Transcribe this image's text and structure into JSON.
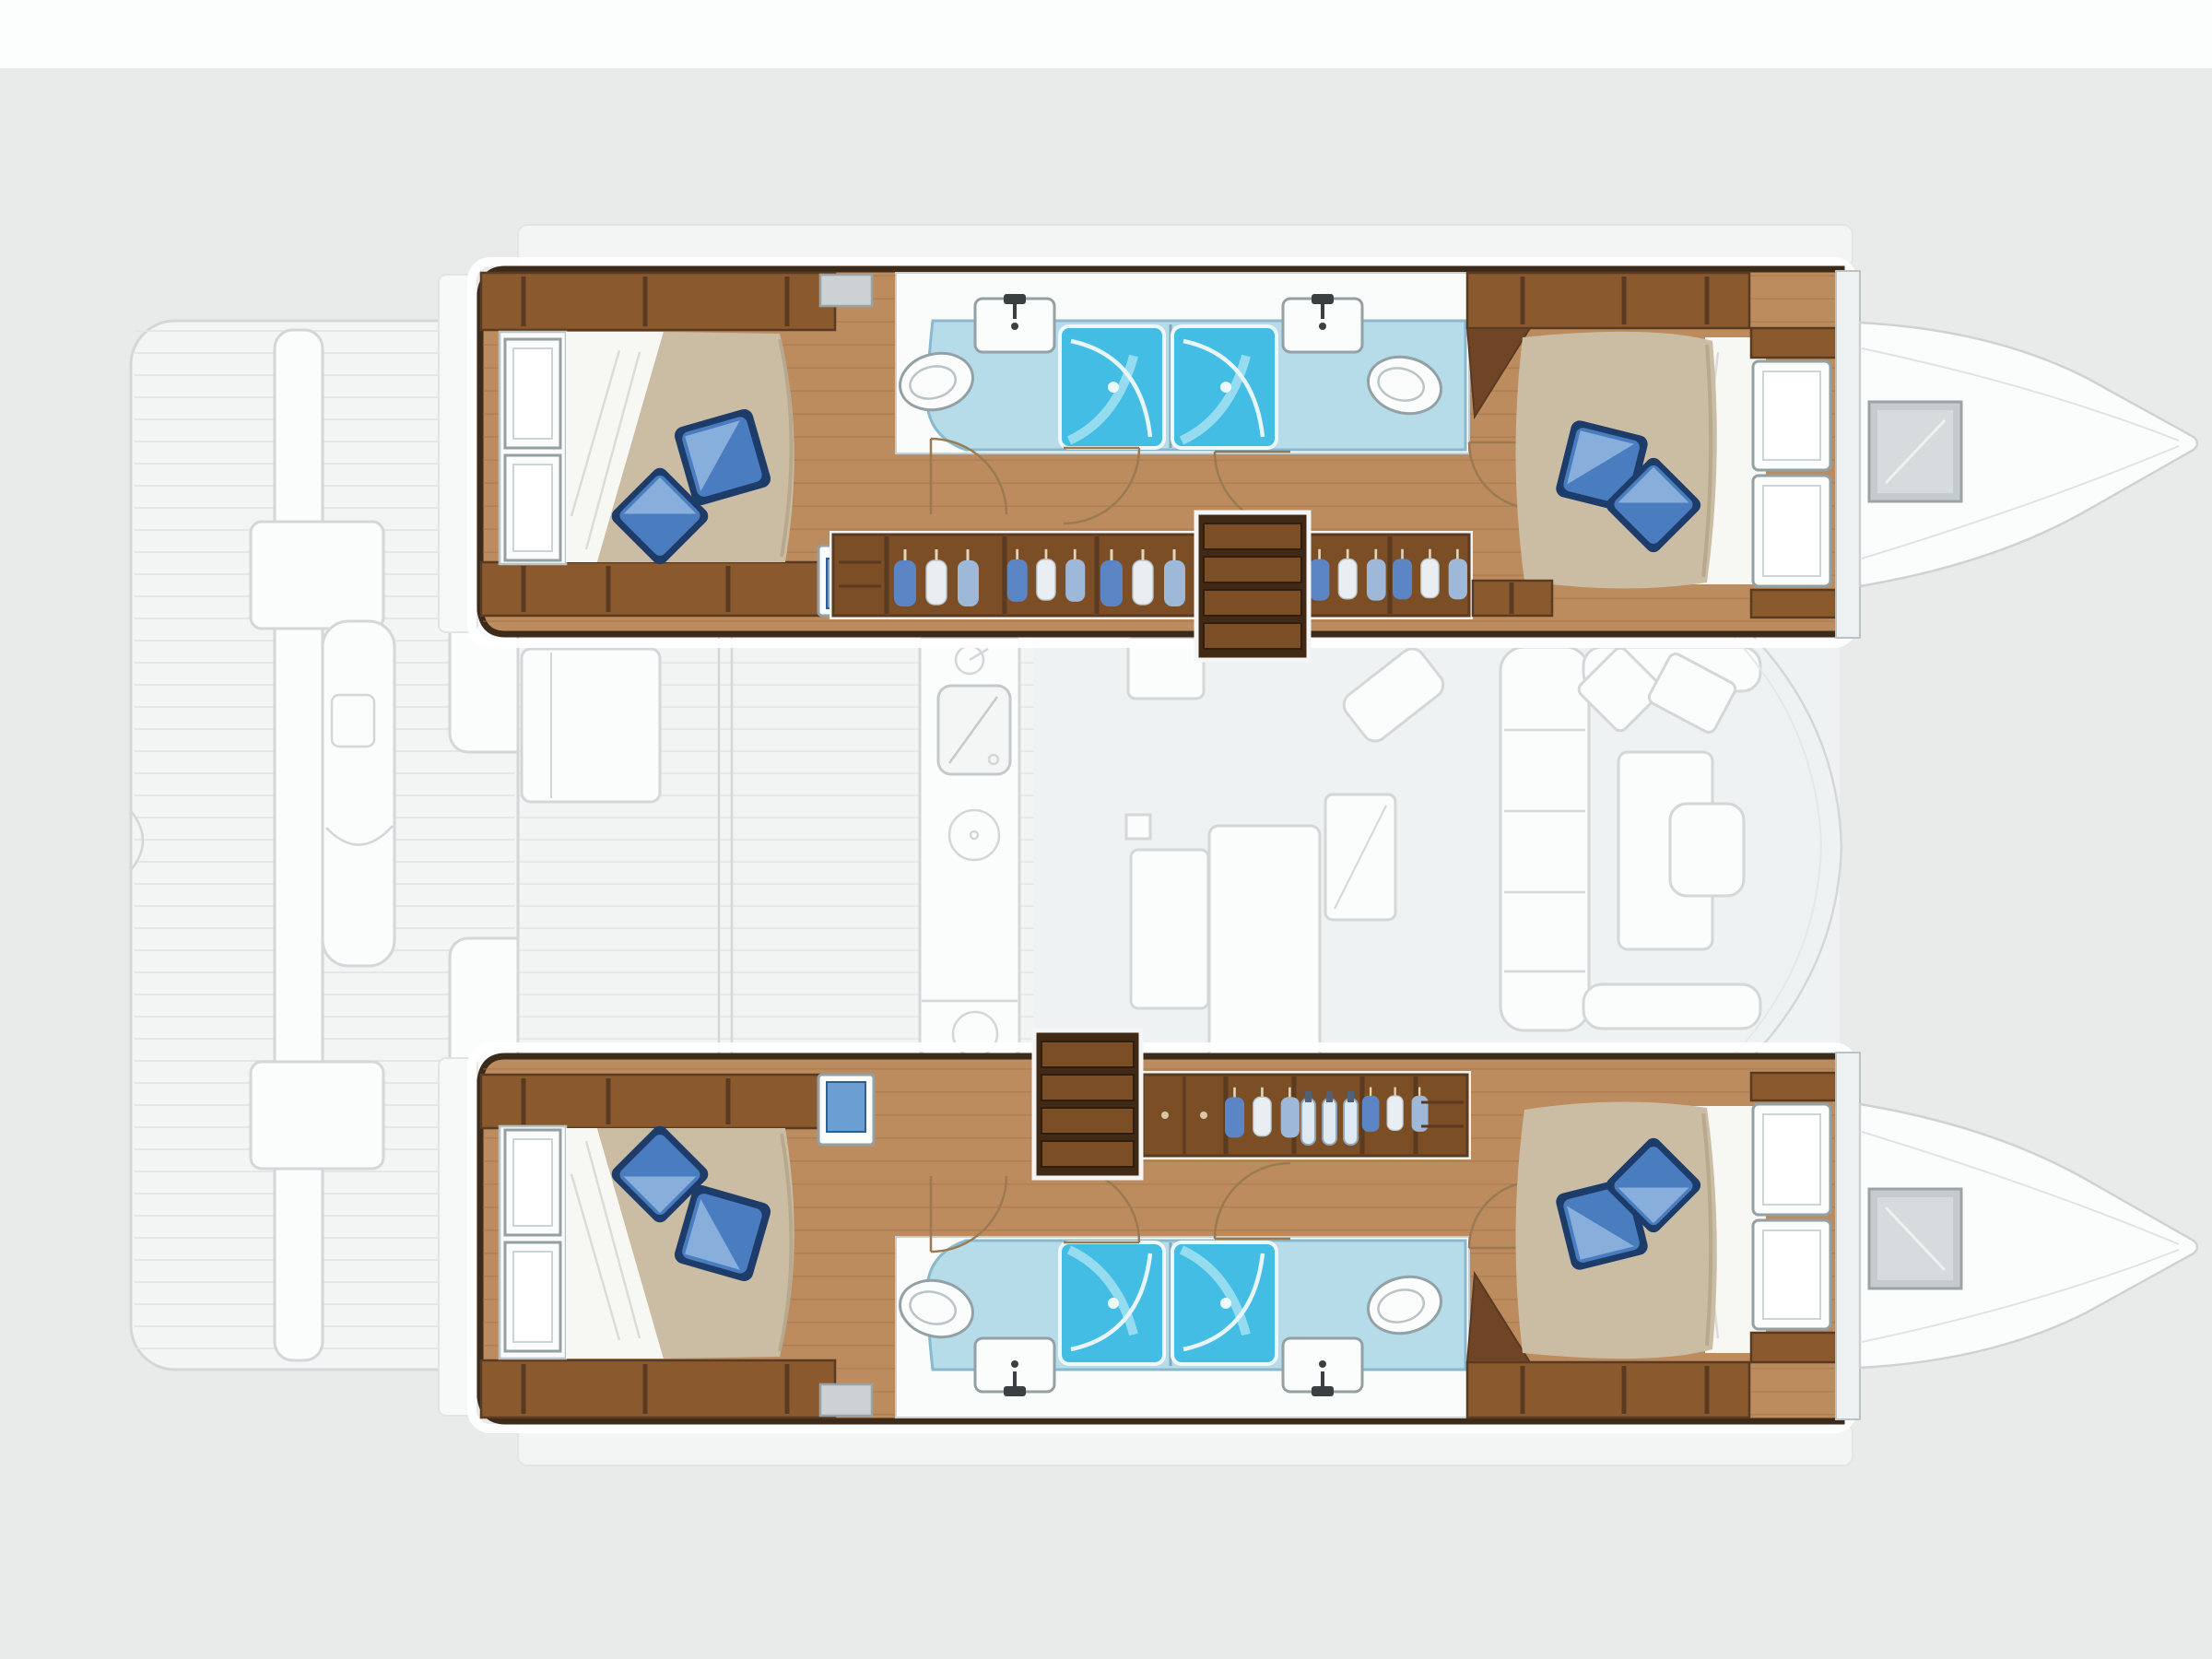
{
  "page": {
    "title": "Catamaran 4-cabin interior floor plan — overhead cutaway, bow to the right"
  },
  "diagram": {
    "type": "floor-plan",
    "subject": "sailing catamaran, 4 double cabins / 4 bathrooms",
    "view": "top-down cutaway of both hulls with ghosted main deck",
    "orientation": "bow-right",
    "counts": {
      "hulls": 2,
      "cabins": 4,
      "double_beds": 4,
      "throw_pillows": 8,
      "bathrooms": 4,
      "shower_stalls": 4,
      "toilets": 4,
      "vanity_sinks": 4,
      "companionway_stairs": 2,
      "hull_windows": 4,
      "bow_deck_hatches": 2
    },
    "port_hull": {
      "label": "port hull (top)",
      "rooms": [
        {
          "name": "aft cabin",
          "features": [
            "double berth, tan mattress",
            "white linen fold",
            "square blue pillow",
            "diamond blue pillow",
            "two hull windows",
            "shelf band",
            "blue-front cabinet"
          ]
        },
        {
          "name": "aft bathroom",
          "features": [
            "tilted oval toilet",
            "vanity sink with faucet",
            "blue shower stall with glass door",
            "door swing arc"
          ]
        },
        {
          "name": "forward bathroom",
          "features": [
            "tilted oval toilet",
            "vanity sink with faucet",
            "blue shower stall with glass door",
            "door swing arc"
          ]
        },
        {
          "name": "corridor",
          "features": [
            "teak plank sole",
            "hanging-locker wardrobes",
            "companionway stairs down from salon"
          ]
        },
        {
          "name": "forward cabin",
          "features": [
            "double berth, tan mattress",
            "square blue pillow",
            "diamond blue pillow",
            "white closet doors",
            "bow bulkhead"
          ]
        },
        {
          "name": "bow (ghosted)",
          "features": [
            "gray deck hatch",
            "faired foredeck lines"
          ]
        }
      ]
    },
    "starboard_hull": {
      "label": "starboard hull (bottom, mirror image)",
      "rooms": [
        {
          "name": "aft cabin",
          "features": [
            "double berth, tan mattress",
            "two blue pillows",
            "two hull windows",
            "shelf band",
            "blue-front cabinet"
          ]
        },
        {
          "name": "aft bathroom",
          "features": [
            "toilet",
            "vanity sink",
            "blue shower stall"
          ]
        },
        {
          "name": "forward bathroom",
          "features": [
            "toilet",
            "vanity sink",
            "blue shower stall"
          ]
        },
        {
          "name": "corridor",
          "features": [
            "companionway stairs landing aft of lockers",
            "wood-door lockers",
            "hanging lockers",
            "glassware locker"
          ]
        },
        {
          "name": "forward cabin",
          "features": [
            "double berth",
            "two blue pillows",
            "white closet doors"
          ]
        },
        {
          "name": "bow (ghosted)",
          "features": [
            "gray deck hatch"
          ]
        }
      ]
    },
    "salon": {
      "label": "main-deck salon (ghosted)",
      "features": [
        "galley strip with faucet sink, stove and burner rings",
        "galley island block",
        "sliding-door tracks to cockpit",
        "port settee",
        "mast step square",
        "two-part dining table",
        "navigation desk with angled seat",
        "U-shaped forward settee with cushion seams",
        "two loose seat cushions",
        "forward table with inner seat pad",
        "curved windshield lines"
      ]
    },
    "cockpit": {
      "label": "aft cockpit and platforms (ghosted)",
      "features": [
        "plank-decked aft platform",
        "white transom bench spine",
        "two transom boxes",
        "helm pod with twin footrests",
        "two cockpit benches",
        "transom step bands behind each hull",
        "side-deck bands along both hulls"
      ]
    }
  },
  "colors": {
    "background": "#e9ebeb",
    "top_strip": "#fcfdfd",
    "ghost_fill": "#f3f5f5",
    "ghost_white": "#fbfcfc",
    "ghost_stroke": "#d2d7d8",
    "ghost_plank": "#e1e5e6",
    "hull_outline": "#3c2b1a",
    "wood_floor": "#bc8b5e",
    "wood_plank": "#9c7146",
    "wood_band": "#8a5a2e",
    "wood_band_dark": "#5a3a20",
    "wood_dark": "#6f4526",
    "wardrobe": "#7b4e26",
    "stair_dark": "#402a15",
    "stair_tread": "#7b4e26",
    "mattress": "#cabda3",
    "mattress_shade": "#b0a287",
    "sheet": "#f7f7f4",
    "pillow_mid": "#4a7cc0",
    "pillow_light": "#8fb4de",
    "pillow_dark": "#1e3c6a",
    "bath_floor": "#b6dbe9",
    "bath_stroke": "#8ab8cd",
    "shower": "#44bde5",
    "shower_light": "#a5e2f2",
    "fixture_white": "#fbfcfc",
    "fixture_stroke": "#93a0a4",
    "faucet": "#3a3f41",
    "cabinet_blue": "#6b9fd4",
    "clothes_blue": "#5b85c4",
    "clothes_white": "#e9eef3",
    "clothes_light": "#9db8d8",
    "glass_blue": "#dfe9f2",
    "door_arc": "#9b7a52",
    "hatch_gray": "#c6cccd"
  }
}
